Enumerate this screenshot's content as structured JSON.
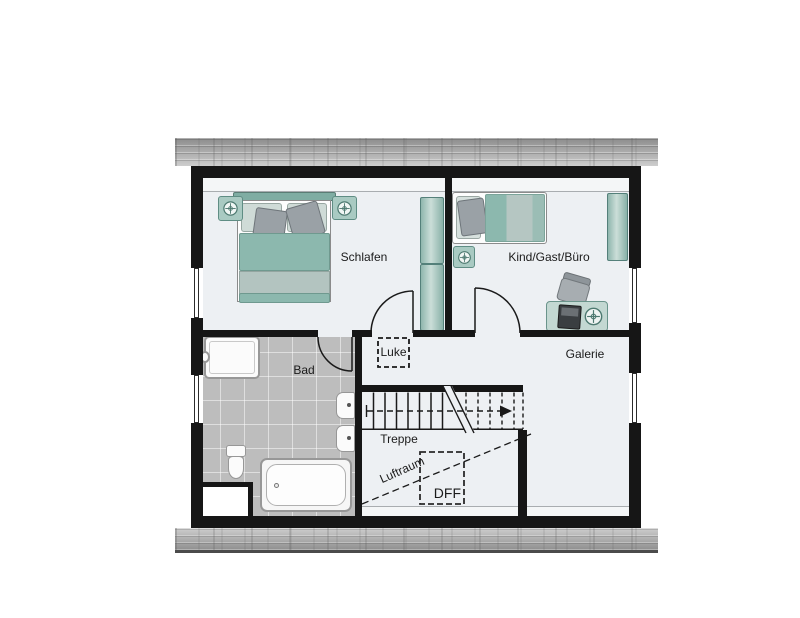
{
  "floorplan": {
    "rooms": {
      "schlafen": {
        "label": "Schlafen"
      },
      "kind_gast_buero": {
        "label": "Kind/Gast/Büro"
      },
      "galerie": {
        "label": "Galerie"
      },
      "bad": {
        "label": "Bad"
      }
    },
    "annotations": {
      "luke": {
        "label": "Luke"
      },
      "treppe": {
        "label": "Treppe"
      },
      "luftraum": {
        "label": "Luftraum"
      },
      "dff": {
        "label": "DFF"
      }
    },
    "icons": {
      "plant": "crosshair-circle",
      "desk_lamp": "crosshair-circle"
    },
    "colors": {
      "wall": "#161616",
      "floor": "#edf0f3",
      "bath_tile": "#bdbdbd",
      "furniture_teal": "#8fb6ad",
      "furniture_gray": "#9aa1a6",
      "roof_band": "#a6a6a6"
    }
  }
}
